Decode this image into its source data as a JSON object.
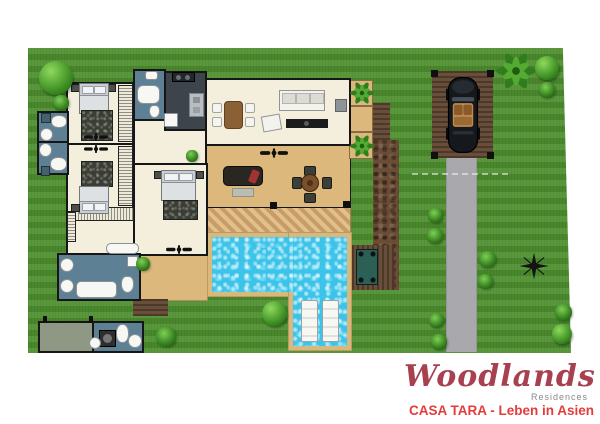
{
  "branding": {
    "logo_text": "Woodlands",
    "logo_sub": "Residences",
    "caption": "CASA TARA - Leben in Asien"
  },
  "palette": {
    "lawn_green": "#4f9130",
    "floor_cream": "#f4eedd",
    "wall_black": "#161616",
    "bathroom_blue": "#5e8095",
    "kitchen_charcoal": "#3d444b",
    "terrace_tan": "#dcb87d",
    "pool_water_cyan": "#3cc3e9",
    "pool_coping_sand": "#d9b87c",
    "deck_brown": "#5f4430",
    "driveway_gray": "#a9a9ad",
    "utility_graygreen": "#8e9885",
    "bench_teal": "#2c5f55",
    "logo_maroon": "#a84050",
    "caption_red": "#e33c3c"
  },
  "icons": {
    "tree": "css-radial-circle",
    "bush": "css-radial-circle",
    "palm-tree": "svg-leaf-star",
    "car": "svg-top-view-convertible",
    "compass-rose": "svg-star-cross",
    "ceiling-fan": "svg-propeller",
    "sun-lounger": "css-striped-rect"
  }
}
